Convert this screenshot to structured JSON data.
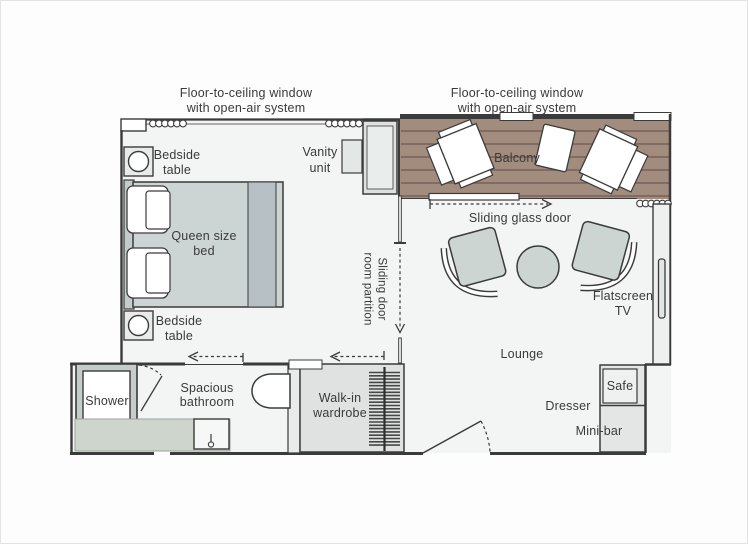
{
  "plan": {
    "title_hint": "Suite floor plan",
    "window_label": {
      "line1": "Floor-to-ceiling window",
      "line2": "with open-air system"
    },
    "rooms": {
      "balcony": "Balcony",
      "lounge": "Lounge",
      "bathroom_line1": "Spacious",
      "bathroom_line2": "bathroom"
    },
    "features": {
      "sliding_glass_door": "Sliding glass door",
      "partition_line1": "Sliding door",
      "partition_line2": "room partition"
    },
    "furniture": {
      "bedside_line1": "Bedside",
      "bedside_line2": "table",
      "bed_line1": "Queen size",
      "bed_line2": "bed",
      "vanity_line1": "Vanity",
      "vanity_line2": "unit",
      "tv_line1": "Flatscreen",
      "tv_line2": "TV",
      "shower": "Shower",
      "wardrobe_line1": "Walk-in",
      "wardrobe_line2": "wardrobe",
      "safe": "Safe",
      "dresser": "Dresser",
      "minibar": "Mini-bar"
    },
    "colors": {
      "wall": "#3b3b3b",
      "deck": "#a28c7e",
      "plank": "#766058",
      "floor": "#f3f4f4",
      "upholstery": "#ccd5d2",
      "counter": "#cdd5cd",
      "text": "#3a3a3a"
    }
  }
}
